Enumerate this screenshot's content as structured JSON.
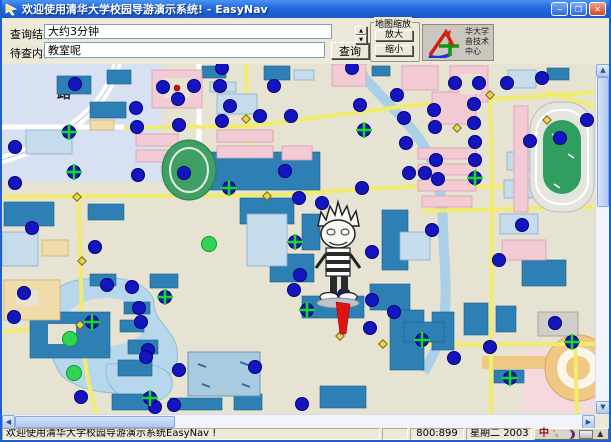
{
  "window": {
    "title": "欢迎使用清华大学校园导游演示系统! - EasyNav",
    "controls": {
      "minimize": "−",
      "maximize": "❐",
      "close": "✕"
    }
  },
  "menu": {
    "help": "(帮助)(H)"
  },
  "toolbar": {
    "query_result_label": "查询结果:",
    "query_result_value": "大约3分钟",
    "query_content_label": "待查内容:",
    "query_content_value": "教室呢",
    "query_button": "查询",
    "spinner_up": "▲",
    "spinner_down": "▼",
    "map_zoom_group": "地图缩放",
    "zoom_in_button": "放大",
    "zoom_out_button": "缩小",
    "logo_lines": [
      "华大学",
      "音技术",
      "中心"
    ]
  },
  "map": {
    "road_label": "路",
    "markers": {
      "blue": [
        [
          73,
          20
        ],
        [
          13,
          83
        ],
        [
          13,
          119
        ],
        [
          134,
          44
        ],
        [
          135,
          63
        ],
        [
          161,
          23
        ],
        [
          192,
          22
        ],
        [
          176,
          35
        ],
        [
          177,
          61
        ],
        [
          136,
          111
        ],
        [
          182,
          109
        ],
        [
          220,
          4
        ],
        [
          218,
          22
        ],
        [
          272,
          22
        ],
        [
          228,
          42
        ],
        [
          258,
          52
        ],
        [
          289,
          52
        ],
        [
          220,
          57
        ],
        [
          350,
          4
        ],
        [
          358,
          41
        ],
        [
          395,
          31
        ],
        [
          402,
          54
        ],
        [
          404,
          79
        ],
        [
          283,
          107
        ],
        [
          297,
          134
        ],
        [
          320,
          139
        ],
        [
          360,
          124
        ],
        [
          407,
          109
        ],
        [
          453,
          19
        ],
        [
          477,
          19
        ],
        [
          505,
          19
        ],
        [
          540,
          14
        ],
        [
          432,
          46
        ],
        [
          472,
          40
        ],
        [
          433,
          63
        ],
        [
          472,
          59
        ],
        [
          473,
          78
        ],
        [
          434,
          96
        ],
        [
          423,
          109
        ],
        [
          436,
          115
        ],
        [
          473,
          96
        ],
        [
          528,
          77
        ],
        [
          558,
          74
        ],
        [
          585,
          56
        ],
        [
          370,
          188
        ],
        [
          298,
          211
        ],
        [
          292,
          226
        ],
        [
          370,
          236
        ],
        [
          342,
          231
        ],
        [
          368,
          264
        ],
        [
          22,
          229
        ],
        [
          12,
          253
        ],
        [
          105,
          221
        ],
        [
          130,
          223
        ],
        [
          137,
          244
        ],
        [
          139,
          258
        ],
        [
          146,
          286
        ],
        [
          144,
          293
        ],
        [
          79,
          333
        ],
        [
          153,
          343
        ],
        [
          172,
          341
        ],
        [
          177,
          306
        ],
        [
          392,
          248
        ],
        [
          452,
          294
        ],
        [
          488,
          283
        ],
        [
          553,
          259
        ],
        [
          253,
          303
        ],
        [
          300,
          340
        ],
        [
          520,
          161
        ],
        [
          497,
          196
        ],
        [
          430,
          166
        ],
        [
          30,
          164
        ],
        [
          93,
          183
        ]
      ],
      "crosshair": [
        [
          67,
          68
        ],
        [
          72,
          108
        ],
        [
          362,
          66
        ],
        [
          473,
          114
        ],
        [
          227,
          124
        ],
        [
          293,
          178
        ],
        [
          305,
          246
        ],
        [
          90,
          258
        ],
        [
          163,
          233
        ],
        [
          148,
          334
        ],
        [
          420,
          276
        ],
        [
          570,
          278
        ],
        [
          508,
          314
        ]
      ],
      "green": [
        [
          68,
          275
        ],
        [
          72,
          309
        ],
        [
          207,
          180
        ]
      ],
      "red": [
        [
          175,
          24
        ]
      ],
      "road_nodes": [
        [
          75,
          133
        ],
        [
          80,
          197
        ],
        [
          78,
          261
        ],
        [
          265,
          132
        ],
        [
          244,
          55
        ],
        [
          381,
          280
        ],
        [
          489,
          281
        ],
        [
          570,
          281
        ],
        [
          545,
          56
        ],
        [
          488,
          31
        ],
        [
          455,
          64
        ],
        [
          338,
          272
        ]
      ]
    }
  },
  "scrollbars": {
    "up": "▲",
    "down": "▼",
    "left": "◀",
    "right": "▶"
  },
  "statusbar": {
    "message": "欢迎使用清华大学校园导游演示系统EasyNav !",
    "coordinates": "800:899",
    "weekday": "星期二",
    "year": "2003",
    "ime": {
      "lang": "中",
      "punct": "'。",
      "soft_keyboard": "▲"
    }
  },
  "colors": {
    "titlebar": "#2A6FE8",
    "marker_blue": "#1515C0",
    "marker_blue_edge": "#00007A",
    "marker_green": "#32D455",
    "cross_green": "#17DD17",
    "marker_red": "#D01010",
    "route_red": "#E31212",
    "road_yellow": "#F2EC6E",
    "road_node_yellow": "#E8D44C",
    "water": "#AFD2E8",
    "field_green": "#2F9E5F",
    "building_blue": "#2E80B4",
    "building_pink": "#F3CBD5"
  }
}
